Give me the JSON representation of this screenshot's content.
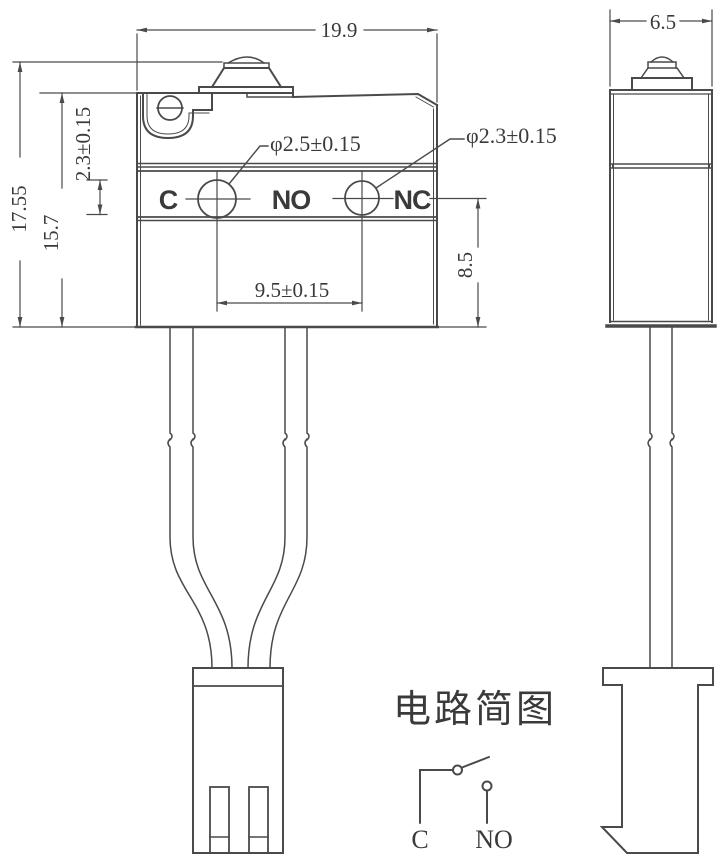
{
  "drawing": {
    "line_color": "#4a4a4a",
    "text_color": "#3a3a3a",
    "background": "#ffffff"
  },
  "front_view": {
    "dim_width": "19.9",
    "dim_total_height": "17.55",
    "dim_body_height": "15.7",
    "dim_hole_vertical": "2.3±0.15",
    "dim_hole1_diameter": "φ2.5±0.15",
    "dim_hole2_diameter": "φ2.3±0.15",
    "dim_hole_pitch": "9.5±0.15",
    "dim_terminal_depth": "8.5",
    "terminals": [
      "C",
      "NO",
      "NC"
    ]
  },
  "side_view": {
    "dim_width": "6.5"
  },
  "circuit": {
    "title": "电路简图",
    "label_common": "C",
    "label_normally_open": "NO"
  }
}
